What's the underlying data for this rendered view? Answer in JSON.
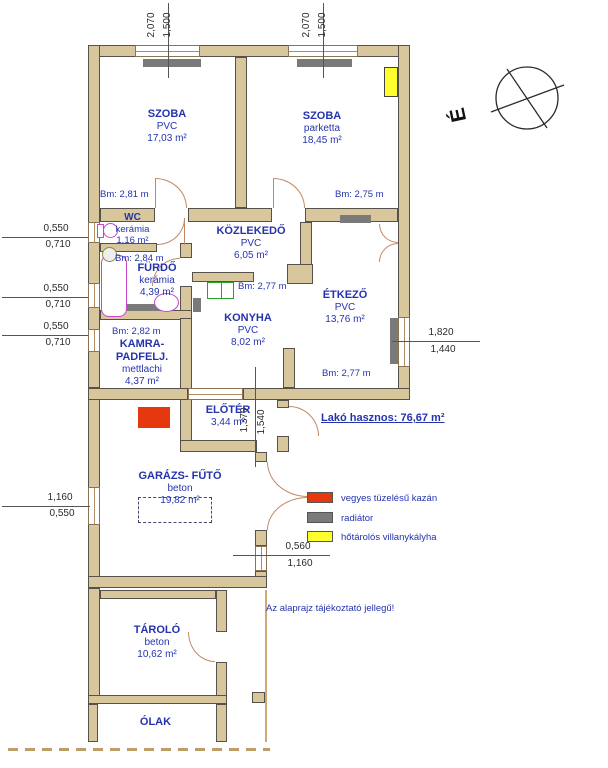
{
  "note": "Az alaprajz tájékoztató jellegű!",
  "total_area": "Lakó hasznos: 76,67 m²",
  "compass": {
    "north_letter": "É"
  },
  "rooms": {
    "szoba_left": {
      "name": "SZOBA",
      "floor": "PVC",
      "area": "17,03 m²",
      "height": "Bm: 2,81 m"
    },
    "szoba_right": {
      "name": "SZOBA",
      "floor": "parketta",
      "area": "18,45 m²",
      "height": "Bm: 2,75 m"
    },
    "wc": {
      "name": "WC",
      "floor": "kerámia",
      "area": "1,16 m²"
    },
    "kozlekedo": {
      "name": "KÖZLEKEDŐ",
      "floor": "PVC",
      "area": "6,05 m²"
    },
    "furdo": {
      "name": "FÜRDŐ",
      "floor": "kerámia",
      "area": "4,39 m²",
      "height": "Bm: 2,84 m"
    },
    "konyha": {
      "name": "KONYHA",
      "floor": "PVC",
      "area": "8,02 m²",
      "height": "Bm: 2,77 m"
    },
    "etkezo": {
      "name": "ÉTKEZŐ",
      "floor": "PVC",
      "area": "13,76 m²",
      "height": "Bm: 2,77 m"
    },
    "kamra": {
      "name_line1": "KAMRA-",
      "name_line2": "PADFELJ.",
      "floor": "mettlachi",
      "area": "4,37 m²",
      "height": "Bm: 2,82 m"
    },
    "eloter": {
      "name": "ELŐTÉR",
      "area": "3,44 m²"
    },
    "garazs": {
      "name": "GARÁZS- FŰTŐ",
      "floor": "beton",
      "area": "19,82 m²"
    },
    "tarolo": {
      "name": "TÁROLÓ",
      "floor": "beton",
      "area": "10,62 m²"
    },
    "olak": {
      "name": "ÓLAK"
    }
  },
  "dims": {
    "top_window_left": [
      "2,070",
      "1,500"
    ],
    "top_window_right": [
      "2,070",
      "1,500"
    ],
    "wc_window": [
      "0,550",
      "0,710"
    ],
    "furdo_window": [
      "0,550",
      "0,710"
    ],
    "kamra_window": [
      "0,550",
      "0,710"
    ],
    "etkezo_window": [
      "1,820",
      "1,440"
    ],
    "garazs_window": [
      "1,160",
      "0,550"
    ],
    "eloter_door": [
      "1,370",
      "1,540"
    ],
    "garazs_door": [
      "0,560",
      "1,160"
    ]
  },
  "legend": [
    {
      "label": "vegyes tüzelésű kazán",
      "color": "#e5380e"
    },
    {
      "label": "radiátor",
      "color": "#7a7a7a"
    },
    {
      "label": "hőtárolós villanykályha",
      "color": "#ffff2e"
    }
  ],
  "colors": {
    "wall": "#d8c79c",
    "label_blue": "#2433ae",
    "boiler_red": "#e5380e",
    "radiator_gray": "#7a7a7a",
    "heater_yellow": "#ffff2e",
    "fixture_magenta": "#cc44cc",
    "sink_green": "#2ca02c"
  }
}
